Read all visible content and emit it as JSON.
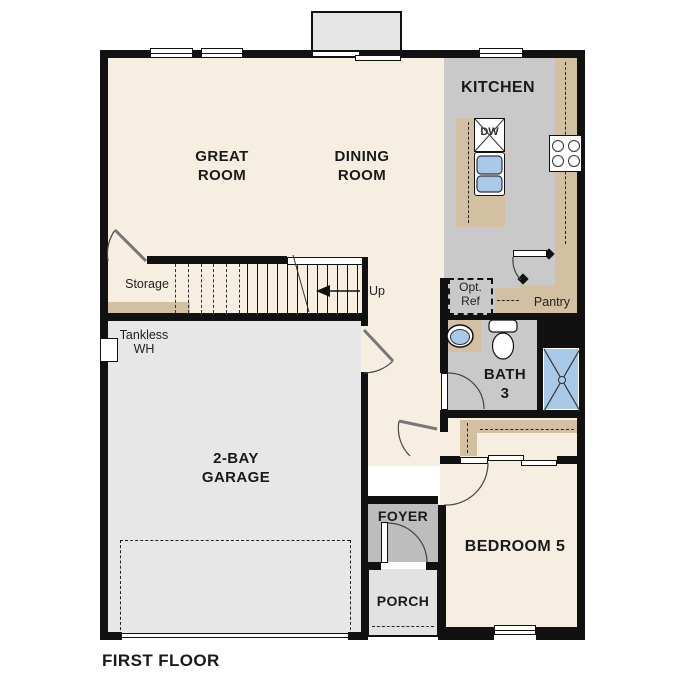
{
  "plan": {
    "title": "FIRST FLOOR"
  },
  "rooms": {
    "great_room": {
      "label": "GREAT\nROOM"
    },
    "dining_room": {
      "label": "DINING\nROOM"
    },
    "kitchen": {
      "label": "KITCHEN"
    },
    "garage": {
      "label": "2-BAY\nGARAGE"
    },
    "bath3": {
      "label": "BATH\n3"
    },
    "bedroom5": {
      "label": "BEDROOM 5"
    },
    "foyer": {
      "label": "FOYER"
    },
    "porch": {
      "label": "PORCH"
    },
    "pantry": {
      "label": "Pantry"
    },
    "storage": {
      "label": "Storage"
    }
  },
  "annotations": {
    "up": "Up",
    "tankless_wh": "Tankless\nWH",
    "opt_ref": "Opt.\nRef",
    "dishwasher": "DW"
  },
  "colors": {
    "floor_cream": "#f6eee1",
    "kitchen_gray": "#c9c9c9",
    "garage_gray": "#e7e7e7",
    "foyer_gray": "#bdbdbd",
    "porch_gray": "#e2e2e2",
    "counter_tan": "#d3c0a2",
    "fixture_blue": "#a9c9e8",
    "wall_black": "#111111"
  }
}
